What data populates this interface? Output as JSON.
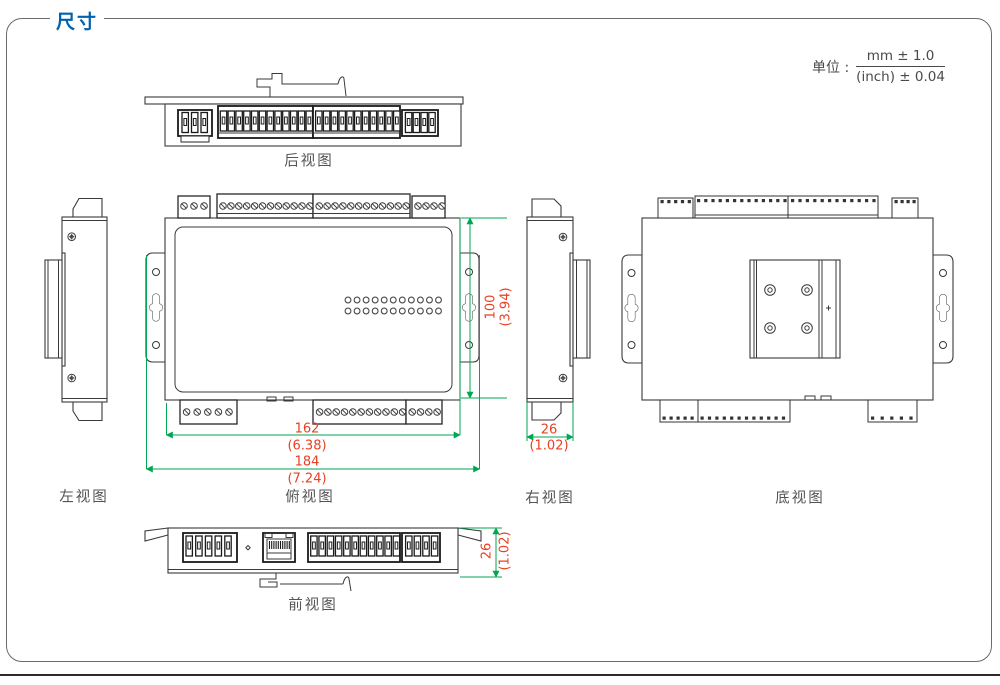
{
  "header": {
    "title": "尺寸",
    "unit_label": "单位 :",
    "unit_mm": "mm ± 1.0",
    "unit_inch": "(inch) ± 0.04"
  },
  "views": {
    "rear": {
      "label": "后视图"
    },
    "left": {
      "label": "左视图"
    },
    "top": {
      "label": "俯视图"
    },
    "right": {
      "label": "右视图"
    },
    "bottom": {
      "label": "底视图"
    },
    "front": {
      "label": "前视图"
    }
  },
  "dimensions": {
    "body_height": {
      "mm": "100",
      "inch": "(3.94)"
    },
    "body_width": {
      "mm": "162",
      "inch": "(6.38)"
    },
    "overall_width": {
      "mm": "184",
      "inch": "(7.24)"
    },
    "side_depth": {
      "mm": "26",
      "inch": "(1.02)"
    },
    "front_depth": {
      "mm": "26",
      "inch": "(1.02)"
    }
  },
  "colors": {
    "accent_blue": "#0062ae",
    "dimension_line": "#00a651",
    "dimension_text": "#e84023",
    "drawing_stroke": "#3a3a3a",
    "label_text": "#595959"
  }
}
